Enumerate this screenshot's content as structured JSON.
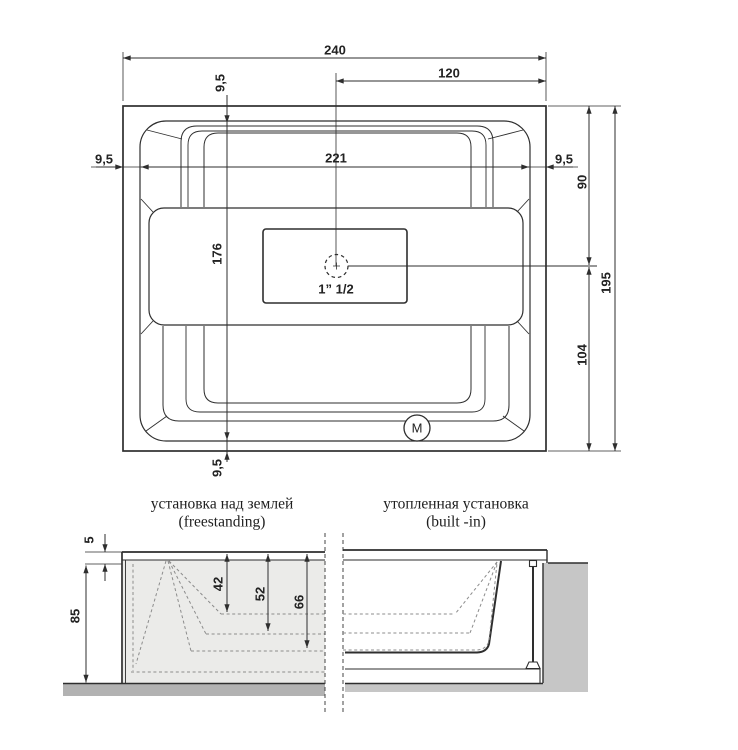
{
  "drawing": {
    "plan": {
      "dim_overall_width": "240",
      "dim_center_to_right": "120",
      "dim_rim_top": "9,5",
      "dim_inner_width": "221",
      "dim_rim_left": "9,5",
      "dim_rim_right": "9,5",
      "dim_inner_length": "176",
      "dim_rim_bottom": "9,5",
      "dim_drain_from_top": "90",
      "dim_overall_length": "195",
      "dim_drain_from_bottom": "104",
      "drain_label": "1” 1/2",
      "motor_label": "M"
    },
    "freestanding": {
      "title_ru": "установка над землей",
      "title_en": "(freestanding)",
      "dim_rim_thickness": "5",
      "dim_total_height": "85",
      "dim_depth_a": "42",
      "dim_depth_b": "52",
      "dim_depth_c": "66"
    },
    "built_in": {
      "title_ru": "утопленная установка",
      "title_en": "(built -in)"
    },
    "colors": {
      "line": "#2e2e2e",
      "tub_section_fill": "#ebebe9",
      "floor_fill": "#b2b2b2",
      "recess_fill": "#c6c6c6",
      "dashed_line": "#8c8c8c"
    }
  }
}
